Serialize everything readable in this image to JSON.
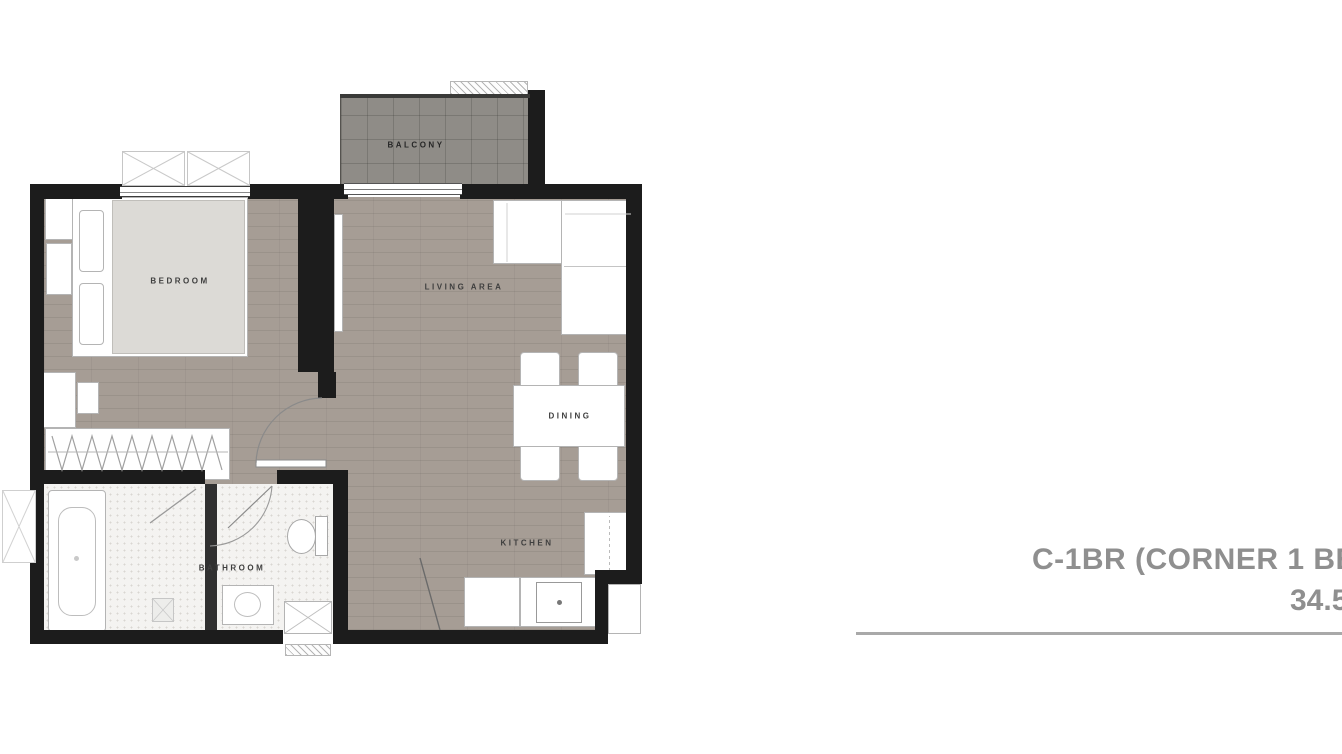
{
  "floorplan": {
    "rooms": {
      "balcony": "BALCONY",
      "bedroom": "BEDROOM",
      "living_area": "LIVING AREA",
      "dining": "DINING",
      "kitchen": "KITCHEN",
      "bathroom": "BATHROOM"
    }
  },
  "title_block": {
    "unit_name": "C-1BR (CORNER 1 BE",
    "area_value": "34.5"
  },
  "colors": {
    "wall": "#1c1c1c",
    "wood_floor": "#a69d95",
    "balcony_floor": "#8f8c87",
    "bathroom_tile": "#f4f3f1",
    "furniture_fill": "#ffffff",
    "bed_fill": "#dcdad6",
    "room_label_text": "#3e3e3e",
    "title_text": "#8f8f8f",
    "divider_line": "#a9a9a9"
  }
}
